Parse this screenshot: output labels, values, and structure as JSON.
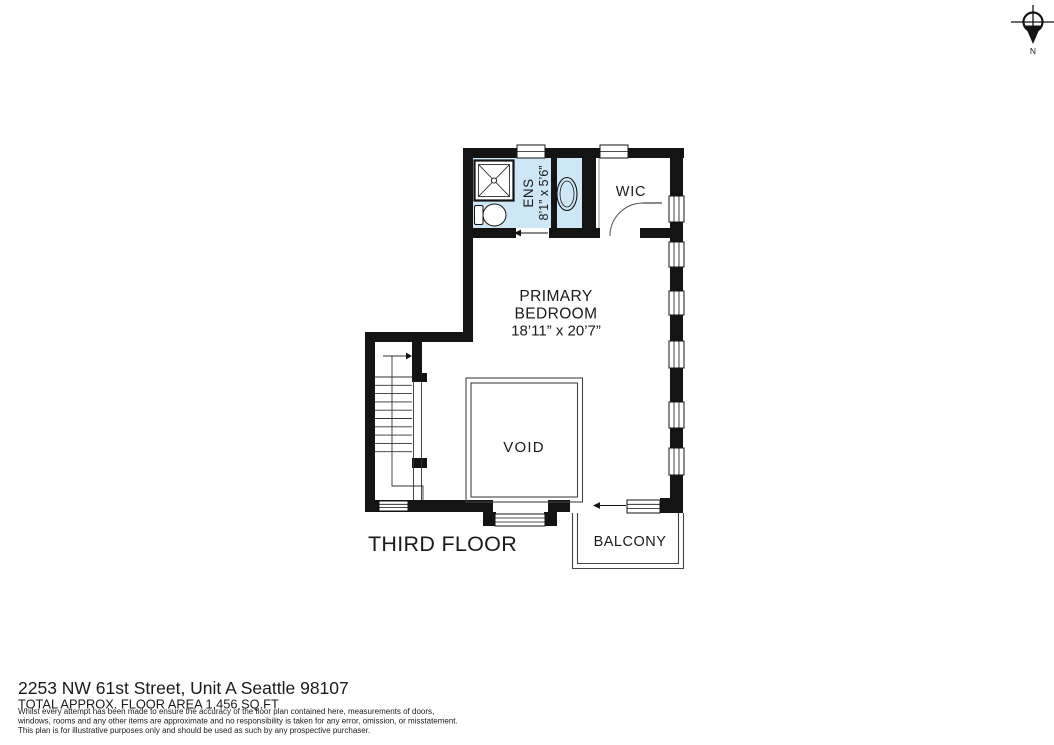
{
  "compass": {
    "north_label": "N"
  },
  "plan": {
    "floor_label": "THIRD FLOOR",
    "rooms": {
      "ens": {
        "name": "ENS",
        "dimensions": "8’1” x 5’6”"
      },
      "wic": {
        "name": "WIC"
      },
      "primary_bedroom": {
        "name_line1": "PRIMARY",
        "name_line2": "BEDROOM",
        "dimensions": "18’11” x 20’7”"
      },
      "void": {
        "name": "VOID"
      },
      "balcony": {
        "name": "BALCONY"
      }
    },
    "colors": {
      "wall": "#141414",
      "ens_fill": "#cde7f7",
      "accent_text": "#24466b"
    }
  },
  "footer": {
    "address": "2253 NW 61st Street, Unit A Seattle 98107",
    "area": "TOTAL APPROX. FLOOR AREA 1,456 SQ.FT",
    "disclaimer_lines": [
      "Whilst every attempt has been made to ensure the accuracy of the floor plan contained here, measurements of doors,",
      "windows, rooms and any other items are approximate and no responsibility is taken for any error, omission, or misstatement.",
      "This plan is for illustrative purposes only and should be used as such by any prospective purchaser."
    ]
  }
}
